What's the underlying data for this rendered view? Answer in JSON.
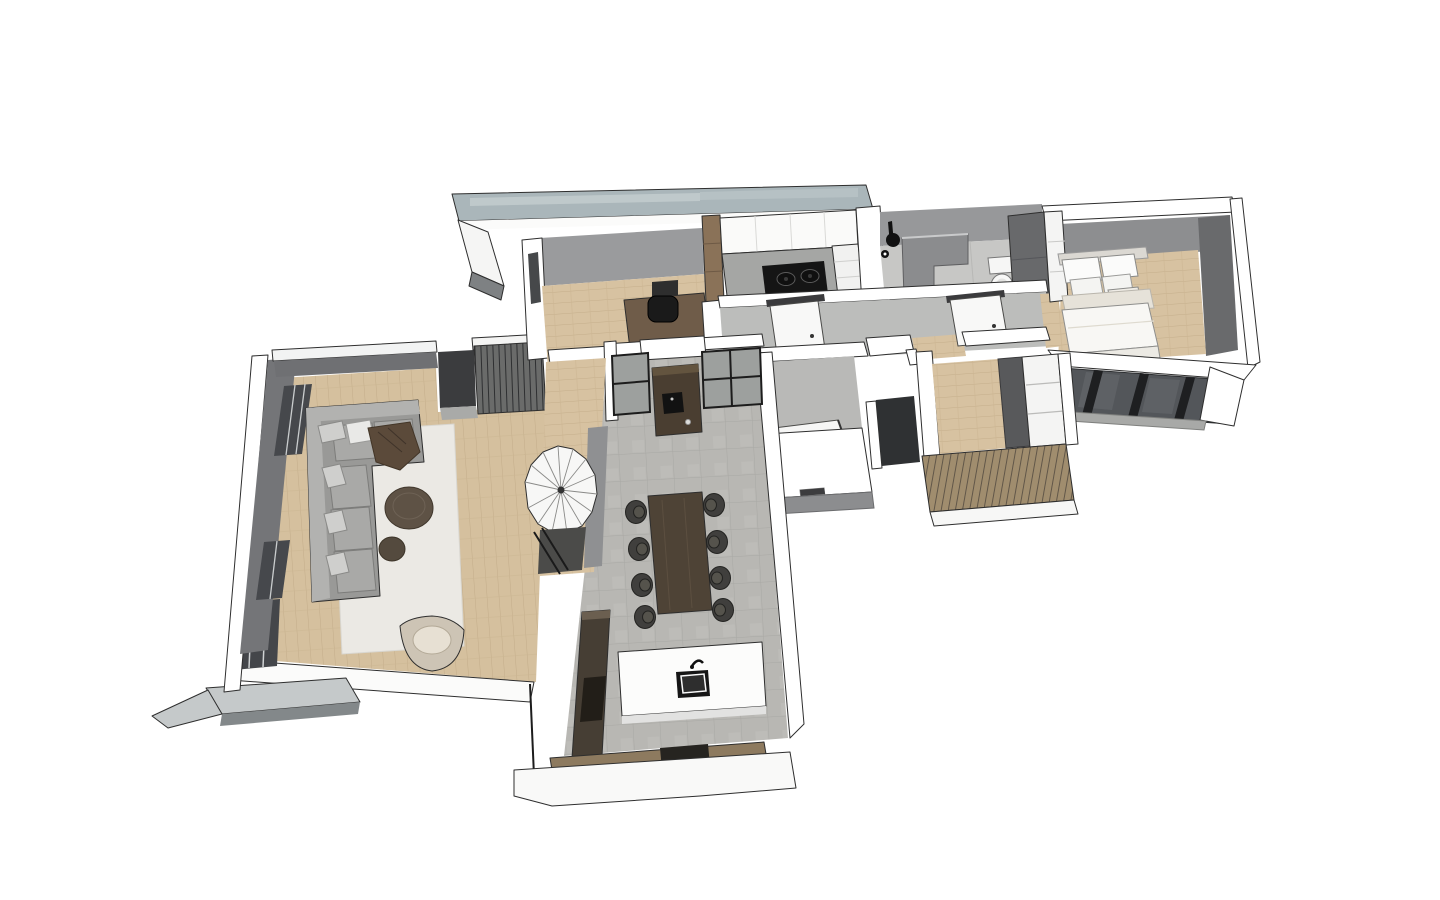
{
  "scene": {
    "title": "3D axonometric floor plan render of a single-storey house",
    "style": "sketchup-like flat shading with black edge lines",
    "background": "#ffffff",
    "view": "bird's-eye view, roof removed, slight rotation to the right"
  },
  "palette": {
    "roof_slab": "#aeb9bc",
    "wall_white": "#ffffff",
    "wall_light": "#ececeb",
    "wall_gray": "#97989a",
    "wall_dark": "#6e6f71",
    "window_dark": "#46484b",
    "frame_black": "#1d1d1d",
    "floor_wood": "#d7c2a1",
    "floor_tile": "#b8b7b3",
    "floor_concrete": "#bcbdbb",
    "slat_wood": "#9d8a6c",
    "sofa_gray": "#9e9e9c",
    "rug_white": "#ebe9e4",
    "table_brown": "#4e4336",
    "chair_black": "#3f3f3d",
    "cabinet_brown": "#4a3e31",
    "bed_white": "#f7f6f3",
    "bench_wood": "#8d7a5f"
  },
  "rooms": [
    {
      "name": "office",
      "floor": "wood",
      "furniture": [
        "desk",
        "monitor",
        "office chair",
        "tall wood cabinet"
      ]
    },
    {
      "name": "kitchen",
      "floor": "tile",
      "furniture": [
        "upper cabinets",
        "counter",
        "two-burner cooktop",
        "drawer unit"
      ]
    },
    {
      "name": "bathroom",
      "floor": "tile",
      "furniture": [
        "shower fixture",
        "partition half-wall",
        "toilet",
        "dark storage cabinet"
      ]
    },
    {
      "name": "bedroom",
      "floor": "wood",
      "furniture": [
        "double bed",
        "pillows",
        "wardrobe",
        "south window wall"
      ]
    },
    {
      "name": "hallway",
      "floor": "concrete",
      "furniture": [
        "interior door",
        "interior door"
      ]
    },
    {
      "name": "walk-in-closet",
      "floor": "wood",
      "furniture": [
        "dark wardrobe",
        "white shelving",
        "wood slat facade"
      ]
    },
    {
      "name": "wc",
      "floor": "concrete",
      "furniture": [
        "open door",
        "wall niche"
      ]
    },
    {
      "name": "dining-area",
      "floor": "tile",
      "furniture": [
        "dining table",
        "eight chairs",
        "coffee cabinet",
        "black framed glass partition"
      ]
    },
    {
      "name": "kitchen-island-run",
      "floor": "tile",
      "furniture": [
        "island counter",
        "sink",
        "faucet",
        "tall dark cabinets",
        "wood bench",
        "stove box"
      ]
    },
    {
      "name": "stair-hall",
      "floor": "wood",
      "furniture": [
        "spiral staircase",
        "black railing"
      ]
    },
    {
      "name": "living-room",
      "floor": "wood",
      "furniture": [
        "corner sofa",
        "throw pillows",
        "brown blanket",
        "white rug",
        "two round coffee tables",
        "armchair",
        "window wall",
        "terrace slab"
      ]
    }
  ]
}
